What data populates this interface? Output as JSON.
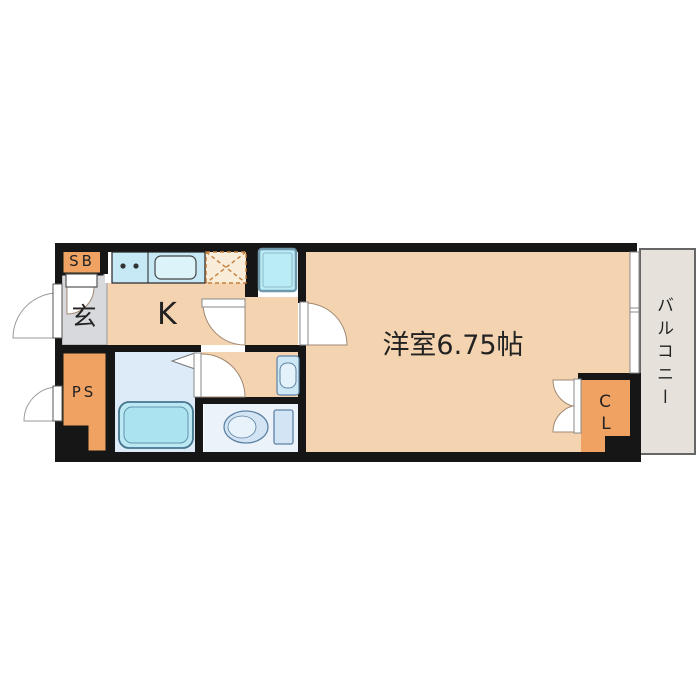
{
  "floor_plan": {
    "title": "1K apartment floor plan",
    "labels": {
      "shoe_box": "SB",
      "entrance": "玄",
      "kitchen": "K",
      "pipe_space": "PS",
      "main_room": "洋室6.75帖",
      "closet_line1": "C",
      "closet_line2": "L",
      "balcony": "バルコニー"
    },
    "rooms": [
      {
        "name": "entrance-genkan",
        "label": "玄"
      },
      {
        "name": "kitchen",
        "label": "K"
      },
      {
        "name": "western-room",
        "label": "洋室6.75帖",
        "size_tatami": 6.75
      },
      {
        "name": "balcony",
        "label": "バルコニー"
      },
      {
        "name": "shoe-box",
        "label": "SB"
      },
      {
        "name": "pipe-space",
        "label": "PS"
      },
      {
        "name": "closet",
        "label": "CL"
      },
      {
        "name": "bathroom",
        "fixtures": [
          "bathtub",
          "folding-door"
        ]
      },
      {
        "name": "washroom",
        "fixtures": [
          "washbasin"
        ]
      },
      {
        "name": "toilet-room",
        "fixtures": [
          "toilet"
        ]
      }
    ],
    "fixtures": [
      "kitchen-counter",
      "stove-burners",
      "kitchen-sink",
      "refrigerator-space",
      "washing-machine-space",
      "bathtub",
      "washbasin",
      "toilet",
      "sliding-window"
    ],
    "colors": {
      "wall": "#161616",
      "floor_peach": "#f4d3b0",
      "entrance_gray": "#d8d9dd",
      "storage_orange": "#f0a263",
      "balcony_gray": "#e6e1da",
      "counter_blue": "#c7e9f5",
      "sink_blue": "#ddf3fa",
      "washer_blue": "#baecf6",
      "bath_floor_blue": "#dcebf7",
      "bathtub_blue": "#bce8f3",
      "toilet_floor": "#ecf2fa",
      "fixture_outline": "#5d82a4",
      "arc_stroke": "#a08872",
      "fridge_dash": "#c4803f",
      "text": "#222222"
    }
  }
}
